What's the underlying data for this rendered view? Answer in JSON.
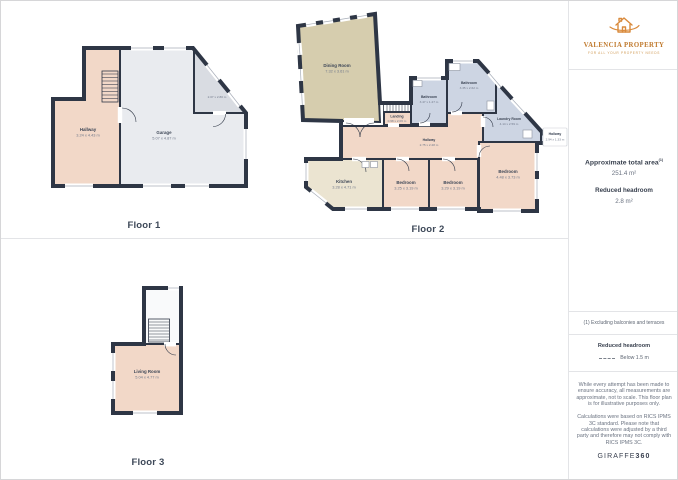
{
  "colors": {
    "accent": "#d98a3c",
    "walls": "#2e3645",
    "room_pink": "#f2d8c8",
    "room_tan": "#d6cdae",
    "room_cream": "#ebe4d1",
    "room_blue": "#cdd5e3",
    "room_gray": "#e9ebef"
  },
  "logo": {
    "title": "VALENCIA PROPERTY",
    "tagline": "FOR ALL YOUR PROPERTY NEEDS"
  },
  "sidebar": {
    "area_title": "Approximate total area",
    "area_sup": "(1)",
    "area_value": "251.4 m²",
    "headroom_title": "Reduced headroom",
    "headroom_value": "2.8 m²",
    "note": "(1) Excluding balconies and terraces",
    "legend_title": "Reduced headroom",
    "legend_value": "Below 1.5 m",
    "disclaimer_1": "While every attempt has been made to ensure accuracy, all measurements are approximate, not to scale. This floor plan is for illustrative purposes only.",
    "disclaimer_2": "Calculations were based on RICS IPMS 3C standard. Please note that calculations were adjusted by a third party and therefore may not comply with RICS IPMS 3C.",
    "footer_brand": "GIRAFFE",
    "footer_brand_bold": "360"
  },
  "floor1": {
    "label": "Floor 1",
    "rooms": {
      "hallway": {
        "name": "Hallway",
        "dims": "3.24 x 4.43 m"
      },
      "garage": {
        "name": "Garage",
        "dims": "5.07 x 4.87 m"
      },
      "store": {
        "dims": "2.07 x 2.80 m"
      }
    }
  },
  "floor2": {
    "label": "Floor 2",
    "rooms": {
      "dining": {
        "name": "Dining Room",
        "dims": "7.32 x 3.61 m"
      },
      "landing": {
        "name": "Landing",
        "dims": "0.98 x 2.06 m"
      },
      "bathroom_small": {
        "name": "Bathroom",
        "dims": "3.47 x 1.27 m"
      },
      "bathroom_large": {
        "name": "Bathroom",
        "dims": "3.35 x 2.62 m"
      },
      "laundry": {
        "name": "Laundry Room",
        "dims": "4.14 x 2.59 m"
      },
      "hallway": {
        "name": "Hallway",
        "dims": "2.75 x 2.28 m"
      },
      "kitchen": {
        "name": "Kitchen",
        "dims": "3.28 x 4.71 m"
      },
      "bedroom_left": {
        "name": "Bedroom",
        "dims": "3.25 x 3.19 m"
      },
      "bedroom_mid": {
        "name": "Bedroom",
        "dims": "3.29 x 3.19 m"
      },
      "bedroom_right": {
        "name": "Bedroom",
        "dims": "4.48 x 3.73 m"
      },
      "hallway_small": {
        "name": "Hallway",
        "dims": "2.94 x 1.33 m"
      }
    }
  },
  "floor3": {
    "label": "Floor 3",
    "rooms": {
      "living": {
        "name": "Living Room",
        "dims": "5.04 x 4.77 m"
      }
    }
  }
}
